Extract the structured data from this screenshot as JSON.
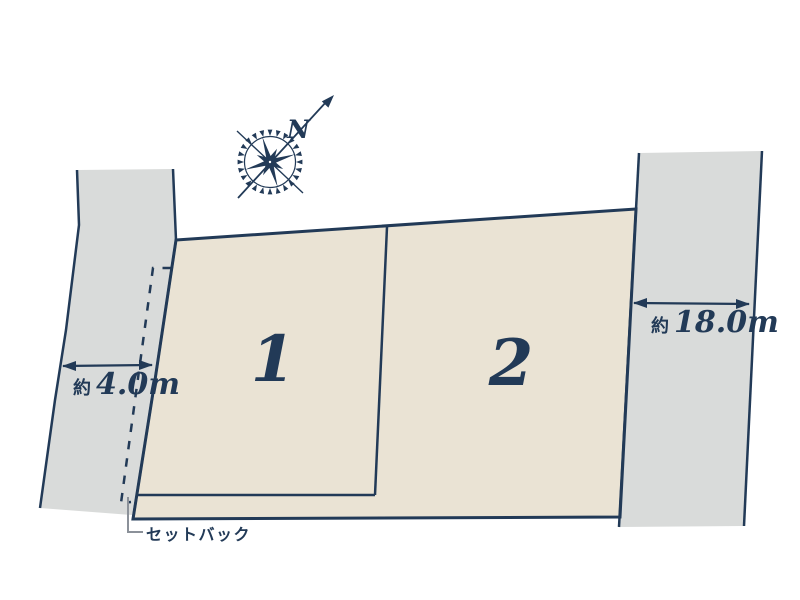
{
  "page": {
    "background": "#ffffff"
  },
  "diagram": {
    "type": "land-plot-layout",
    "colors": {
      "outline_navy": "#223a57",
      "road_fill": "#d9dbda",
      "lot_fill": "#eae3d4",
      "leader_gray": "#8b9199",
      "background": "#ffffff"
    },
    "lots": [
      {
        "number": "1"
      },
      {
        "number": "2"
      }
    ],
    "dimensions": {
      "left_road": {
        "prefix": "約",
        "value": "4.0m"
      },
      "right_road": {
        "prefix": "約",
        "value": "18.0m"
      }
    },
    "setback_label": "セットバック",
    "compass": {
      "north_label": "N"
    }
  }
}
